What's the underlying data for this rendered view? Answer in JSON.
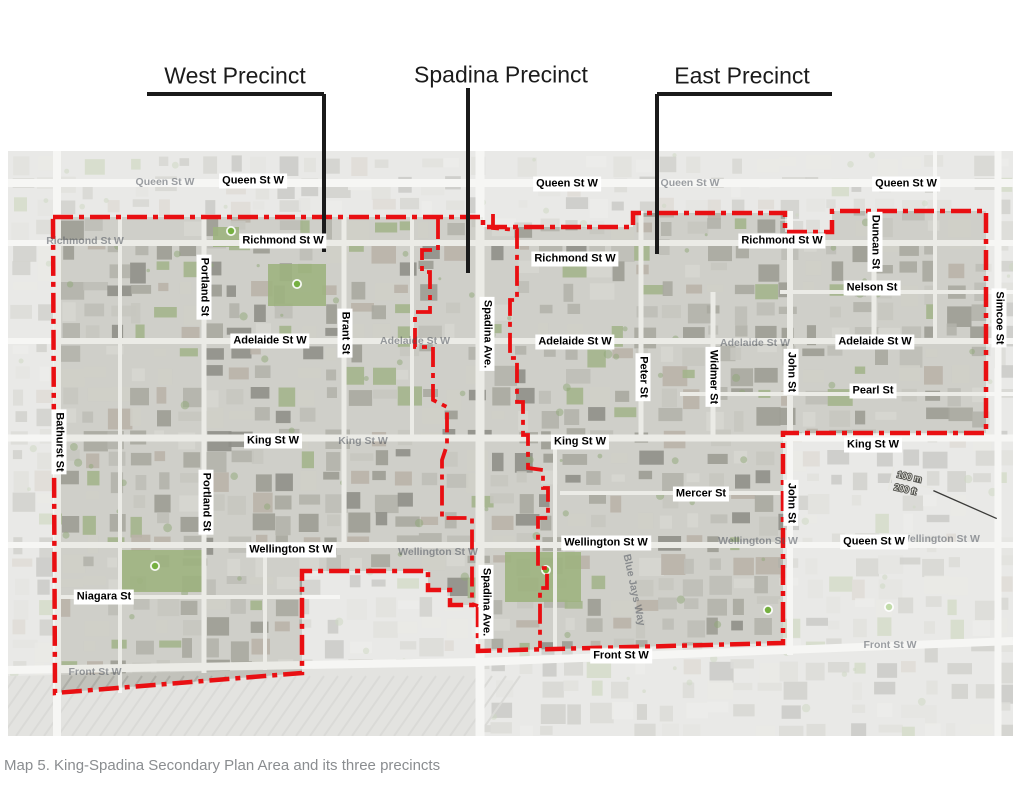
{
  "caption": "Map 5. King-Spadina Secondary Plan Area and its three precincts",
  "precincts": [
    {
      "label": "West Precinct",
      "x": 235,
      "y": 76,
      "underline": [
        147,
        94,
        324,
        94
      ],
      "leader": [
        324,
        94,
        324,
        252
      ]
    },
    {
      "label": "Spadina Precinct",
      "x": 501,
      "y": 75,
      "leader": [
        468,
        88,
        468,
        273
      ]
    },
    {
      "label": "East Precinct",
      "x": 742,
      "y": 76,
      "underline": [
        657,
        94,
        832,
        94
      ],
      "leader": [
        657,
        94,
        657,
        254
      ]
    }
  ],
  "map": {
    "x": 8,
    "y": 151,
    "width": 1005,
    "height": 585,
    "boundary_color": "#e90f12",
    "leader_color": "#1a1a1a",
    "outer_boundary": [
      [
        53,
        217
      ],
      [
        483,
        217
      ],
      [
        483,
        227
      ],
      [
        633,
        227
      ],
      [
        633,
        213
      ],
      [
        785,
        213
      ],
      [
        785,
        232
      ],
      [
        832,
        232
      ],
      [
        832,
        211
      ],
      [
        986,
        211
      ],
      [
        986,
        433
      ],
      [
        783,
        433
      ],
      [
        783,
        643
      ],
      [
        478,
        651
      ],
      [
        478,
        605
      ],
      [
        450,
        605
      ],
      [
        450,
        590
      ],
      [
        428,
        590
      ],
      [
        428,
        571
      ],
      [
        302,
        571
      ],
      [
        302,
        673
      ],
      [
        55,
        693
      ],
      [
        53,
        217
      ]
    ],
    "divider_west": [
      [
        438,
        219
      ],
      [
        438,
        250
      ],
      [
        422,
        250
      ],
      [
        422,
        272
      ],
      [
        430,
        272
      ],
      [
        430,
        312
      ],
      [
        415,
        312
      ],
      [
        415,
        347
      ],
      [
        433,
        347
      ],
      [
        433,
        400
      ],
      [
        447,
        407
      ],
      [
        447,
        445
      ],
      [
        442,
        460
      ],
      [
        442,
        518
      ],
      [
        472,
        518
      ],
      [
        472,
        604
      ],
      [
        478,
        606
      ]
    ],
    "divider_east": [
      [
        493,
        214
      ],
      [
        493,
        228
      ],
      [
        517,
        230
      ],
      [
        517,
        300
      ],
      [
        510,
        300
      ],
      [
        510,
        358
      ],
      [
        517,
        358
      ],
      [
        517,
        402
      ],
      [
        523,
        402
      ],
      [
        523,
        435
      ],
      [
        528,
        435
      ],
      [
        528,
        468
      ],
      [
        543,
        470
      ],
      [
        543,
        488
      ],
      [
        548,
        488
      ],
      [
        548,
        518
      ],
      [
        538,
        518
      ],
      [
        538,
        568
      ],
      [
        547,
        568
      ],
      [
        547,
        588
      ],
      [
        540,
        588
      ],
      [
        540,
        648
      ]
    ],
    "streets_h": [
      {
        "y": 183,
        "w": 8,
        "x1": 8,
        "x2": 1013
      },
      {
        "y": 243,
        "w": 6,
        "x1": 8,
        "x2": 1013
      },
      {
        "y": 341,
        "w": 6,
        "x1": 8,
        "x2": 1013
      },
      {
        "y": 438,
        "w": 7,
        "x1": 8,
        "x2": 1013
      },
      {
        "y": 545,
        "w": 6,
        "x1": 8,
        "x2": 1013
      },
      {
        "y": 292,
        "w": 4,
        "x1": 780,
        "x2": 1013
      },
      {
        "y": 394,
        "w": 4,
        "x1": 680,
        "x2": 1013
      },
      {
        "y": 493,
        "w": 4,
        "x1": 560,
        "x2": 790
      },
      {
        "y": 597,
        "w": 4,
        "x1": 57,
        "x2": 340
      }
    ],
    "front_street": [
      [
        8,
        670
      ],
      [
        480,
        662
      ],
      [
        1013,
        641
      ]
    ],
    "streets_v": [
      {
        "x": 57,
        "w": 8,
        "y1": 151,
        "y2": 736
      },
      {
        "x": 120,
        "w": 4,
        "y1": 217,
        "y2": 693
      },
      {
        "x": 204,
        "w": 5,
        "y1": 217,
        "y2": 673
      },
      {
        "x": 265,
        "w": 4,
        "y1": 545,
        "y2": 670
      },
      {
        "x": 344,
        "w": 5,
        "y1": 217,
        "y2": 545
      },
      {
        "x": 412,
        "w": 4,
        "y1": 217,
        "y2": 440
      },
      {
        "x": 480,
        "w": 9,
        "y1": 151,
        "y2": 736
      },
      {
        "x": 555,
        "w": 4,
        "y1": 438,
        "y2": 650
      },
      {
        "x": 641,
        "w": 5,
        "y1": 211,
        "y2": 440
      },
      {
        "x": 713,
        "w": 5,
        "y1": 292,
        "y2": 440
      },
      {
        "x": 790,
        "w": 6,
        "y1": 211,
        "y2": 655
      },
      {
        "x": 874,
        "w": 5,
        "y1": 211,
        "y2": 341
      },
      {
        "x": 935,
        "w": 4,
        "y1": 151,
        "y2": 341
      },
      {
        "x": 998,
        "w": 7,
        "y1": 151,
        "y2": 736
      }
    ],
    "parks": [
      [
        268,
        264,
        58,
        42
      ],
      [
        213,
        227,
        26,
        20
      ],
      [
        118,
        550,
        84,
        42
      ],
      [
        505,
        552,
        76,
        50
      ]
    ],
    "park_markers": [
      [
        231,
        231
      ],
      [
        297,
        284
      ],
      [
        155,
        566
      ],
      [
        546,
        570
      ],
      [
        768,
        610
      ],
      [
        889,
        607
      ]
    ],
    "street_labels_h": [
      {
        "text": "Queen St W",
        "x": 253,
        "y": 181
      },
      {
        "text": "Queen St W",
        "x": 567,
        "y": 184
      },
      {
        "text": "Queen St W",
        "x": 906,
        "y": 184
      },
      {
        "text": "Richmond St W",
        "x": 283,
        "y": 241
      },
      {
        "text": "Richmond St W",
        "x": 575,
        "y": 259
      },
      {
        "text": "Richmond St W",
        "x": 782,
        "y": 241
      },
      {
        "text": "Nelson St",
        "x": 872,
        "y": 288
      },
      {
        "text": "Adelaide St W",
        "x": 270,
        "y": 341
      },
      {
        "text": "Adelaide St W",
        "x": 575,
        "y": 342
      },
      {
        "text": "Adelaide St W",
        "x": 875,
        "y": 342
      },
      {
        "text": "Pearl St",
        "x": 873,
        "y": 391
      },
      {
        "text": "King St W",
        "x": 273,
        "y": 441
      },
      {
        "text": "King St W",
        "x": 580,
        "y": 442
      },
      {
        "text": "King St W",
        "x": 873,
        "y": 445
      },
      {
        "text": "Mercer St",
        "x": 701,
        "y": 494
      },
      {
        "text": "Wellington St W",
        "x": 291,
        "y": 550
      },
      {
        "text": "Wellington St W",
        "x": 606,
        "y": 543
      },
      {
        "text": "Queen St W",
        "x": 874,
        "y": 542
      },
      {
        "text": "Niagara St",
        "x": 104,
        "y": 597
      },
      {
        "text": "Front St W",
        "x": 621,
        "y": 656
      }
    ],
    "street_labels_v": [
      {
        "text": "Portland St",
        "x": 204,
        "y": 287
      },
      {
        "text": "Brant St",
        "x": 345,
        "y": 333
      },
      {
        "text": "Spadina Ave.",
        "x": 487,
        "y": 334
      },
      {
        "text": "Peter St",
        "x": 643,
        "y": 377
      },
      {
        "text": "Widmer St",
        "x": 713,
        "y": 377
      },
      {
        "text": "John St",
        "x": 791,
        "y": 372
      },
      {
        "text": "Duncan St",
        "x": 875,
        "y": 242
      },
      {
        "text": "Simcoe St",
        "x": 999,
        "y": 318
      },
      {
        "text": "Bathurst St",
        "x": 59,
        "y": 442
      },
      {
        "text": "Portland St",
        "x": 206,
        "y": 502
      },
      {
        "text": "Spadina Ave.",
        "x": 486,
        "y": 602
      },
      {
        "text": "John St",
        "x": 791,
        "y": 503
      }
    ],
    "faint_labels": [
      {
        "text": "Queen St W",
        "x": 165,
        "y": 182
      },
      {
        "text": "Queen St W",
        "x": 690,
        "y": 183
      },
      {
        "text": "Richmond St W",
        "x": 85,
        "y": 241
      },
      {
        "text": "Adelaide St W",
        "x": 415,
        "y": 341
      },
      {
        "text": "Adelaide St W",
        "x": 755,
        "y": 343
      },
      {
        "text": "King St W",
        "x": 363,
        "y": 441
      },
      {
        "text": "Wellington St W",
        "x": 438,
        "y": 552
      },
      {
        "text": "Wellington St W",
        "x": 758,
        "y": 541
      },
      {
        "text": "Wellington St W",
        "x": 940,
        "y": 539
      },
      {
        "text": "Front St W",
        "x": 95,
        "y": 672
      },
      {
        "text": "Front St W",
        "x": 890,
        "y": 645
      },
      {
        "text": "Blue Jays Way",
        "x": 634,
        "y": 590,
        "rot": true
      }
    ],
    "scale_bar": {
      "metric": "100 m",
      "imperial": "200 ft",
      "x": 893,
      "y": 470,
      "angle": 13
    }
  }
}
